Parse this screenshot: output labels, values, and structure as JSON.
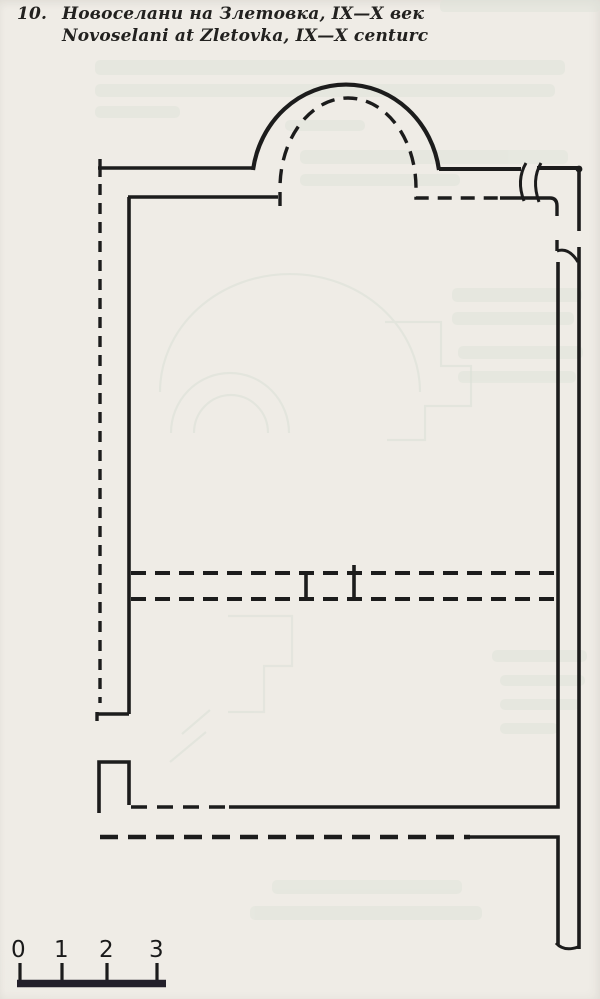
{
  "page": {
    "background_color": "#edeae4",
    "ink_color": "#1c1c1c",
    "ghost_bleedthrough_color": "#dde2d8"
  },
  "figure": {
    "number": "10.",
    "caption_line1": "Новоселани на Злетовка, IX—X век",
    "caption_line2": "Novoselani at Zletovka, IX—X centurc"
  },
  "plan": {
    "description": "hand-drawn church floor plan: semicircular apse at top (solid outer arc, dashed inner arc), naos and narthex walls in solid and dashed excavation lines"
  },
  "scale_bar": {
    "labels": [
      "0",
      "1",
      "2",
      "3"
    ]
  }
}
